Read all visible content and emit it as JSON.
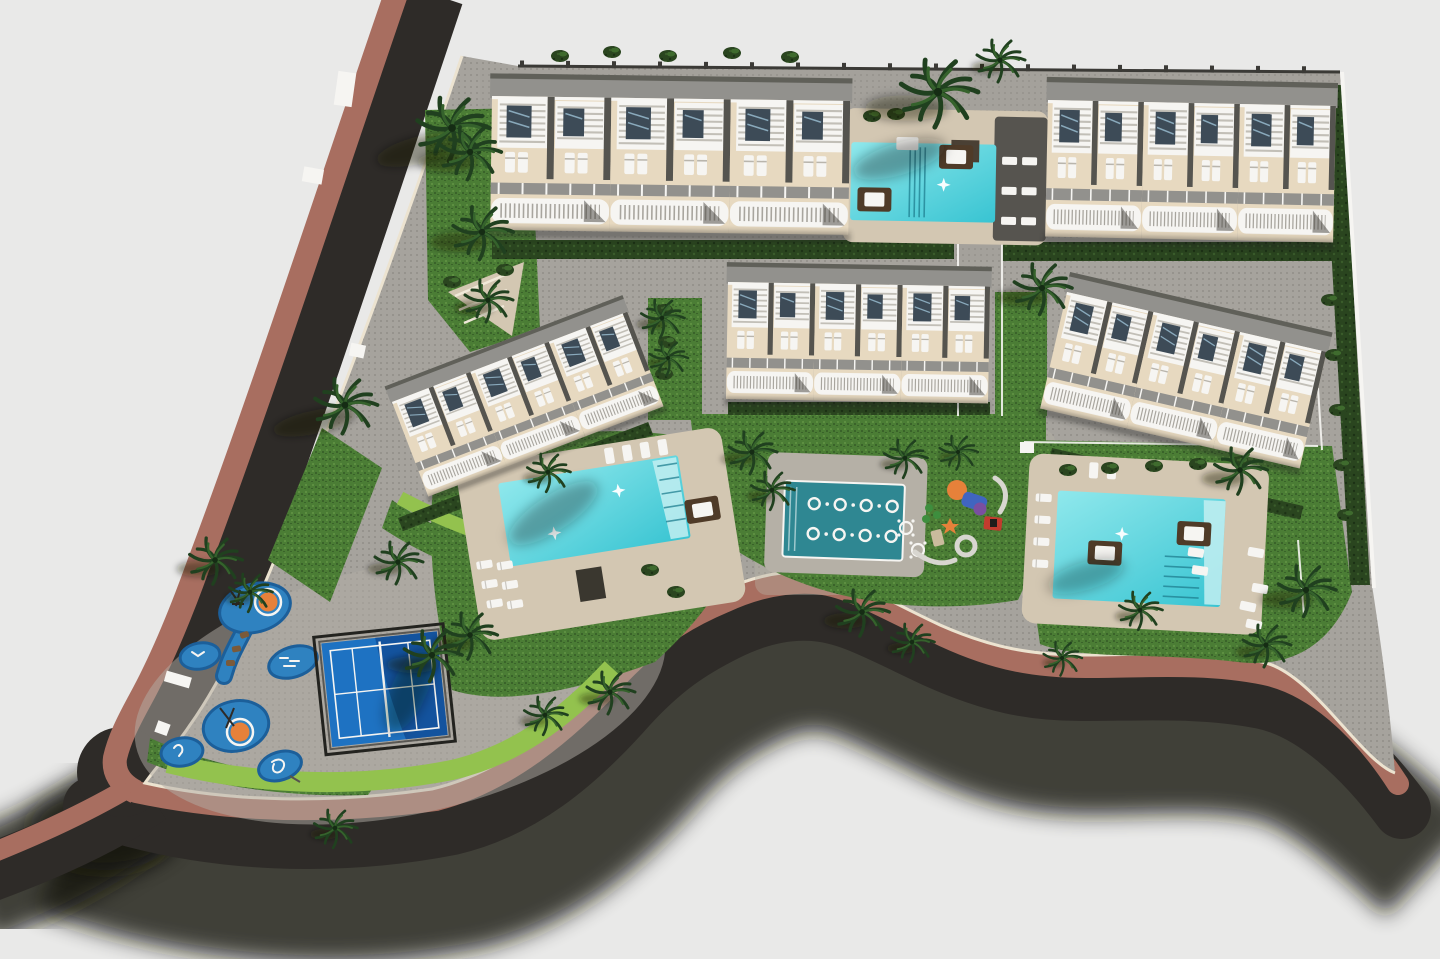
{
  "scene": {
    "description": "Aerial top-down 3D architectural rendering of a residential complex site plan: five cream apartment blocks with white rooftop pergolas, three turquoise swimming pools, a spa jet pool, a blue paddle-tennis court, a children's splash playground, lawns, clipped hedges and palm trees, bounded by a dark asphalt road with a brick-paved sidewalk on a light gray base.",
    "view": "plan view render",
    "text_content": "none (image contains no text)"
  },
  "colors": {
    "background": "#e9e9e8",
    "asphalt": "#2e2b28",
    "road_shadow": "#16130f",
    "brick": "#a86e60",
    "curb": "#ece3d0",
    "paving": "#a6a39d",
    "paving_dot": "#918e88",
    "deck_tan": "#d3c7b2",
    "building_cream": "#e7d9c0",
    "roof_gray": "#92918d",
    "roof_dark": "#606059",
    "divider": "#55544f",
    "white": "#f6f5f2",
    "glass": "#3d4b57",
    "glass_light": "#9cc0d4",
    "water_light": "#8fe8ec",
    "water": "#38c4d2",
    "spa_water": "#2f8792",
    "court_blue": "#1e72c2",
    "court_blue_dark": "#12509a",
    "frame_black": "#23231f",
    "splash_blue": "#2f82c0",
    "splash_dark": "#1c5f9a",
    "orange": "#e6813a",
    "grass": "#4b7d35",
    "grass_dark": "#3a632a",
    "lime": "#93c24e",
    "hedge": "#2a451f",
    "palm": "#20401f",
    "daybed_brown": "#4f3b28"
  },
  "inventory": {
    "apartment_blocks": 5,
    "townhouse_units_per_block": 3,
    "swimming_pools": 3,
    "spa_pool": 1,
    "spa_jet_rings": 8,
    "paddle_tennis_court": 1,
    "kids_splash_pads": 6,
    "playground_areas": 2,
    "palm_trees": 30,
    "shrubs": 24,
    "pool_loungers": 33,
    "daybeds": 5,
    "perimeter_roads": 2,
    "brick_sidewalk": 1,
    "site_boundary_walls": 2
  }
}
